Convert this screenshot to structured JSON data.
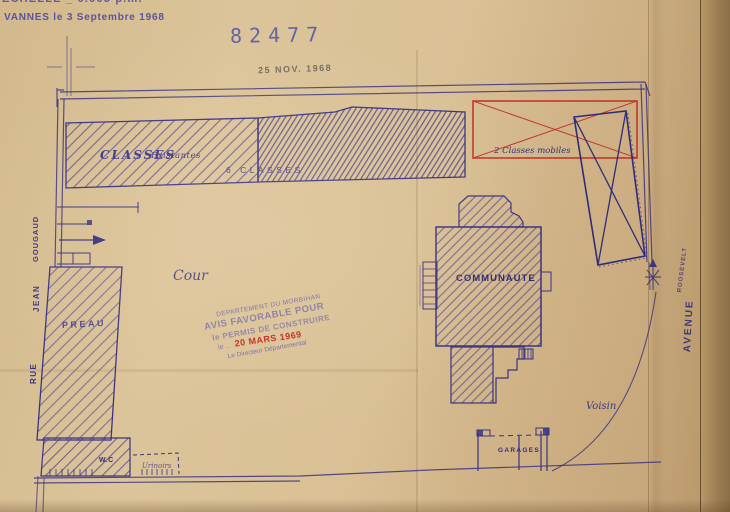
{
  "document": {
    "scale_note": "ECHELLE _ 0.005 p.m.",
    "place_date": "VANNES le 3 Septembre 1968",
    "registry_number": "82477",
    "received_date_stamp": "25 NOV. 1968"
  },
  "approval_stamp": {
    "department": "DEPARTEMENT DU MORBIHAN",
    "line_avis": "AVIS FAVORABLE POUR",
    "line_permis": "le PERMIS DE CONSTRUIRE",
    "date_prefix": "le ..",
    "date_red": "20 MARS 1969",
    "signature_line": "Le Directeur Départemental"
  },
  "plan": {
    "labels": {
      "classes": "CLASSES",
      "classes_existantes": "Existantes",
      "classes_count": "6 CLASSES",
      "classes_mobiles": "2 Classes mobiles",
      "communaute": "COMMUNAUTE",
      "preau": "PREAU",
      "cour": "Cour",
      "voisin": "Voisin",
      "garages": "GARAGES",
      "wc": "W.C",
      "urinoirs": "Urinoirs"
    },
    "streets": {
      "rue": "RUE",
      "jean": "JEAN",
      "gougaud": "GOUGAUD",
      "avenue": "AVENUE",
      "roosevelt": "ROOSEVELT"
    }
  },
  "colors": {
    "paper": "#d8bf93",
    "ink_blue": "#3a3383",
    "stamp_blue": "#5a55a8",
    "stamp_red": "#c2271c",
    "annotation_red": "#c0392b",
    "registry_blue": "#4d51a6"
  }
}
